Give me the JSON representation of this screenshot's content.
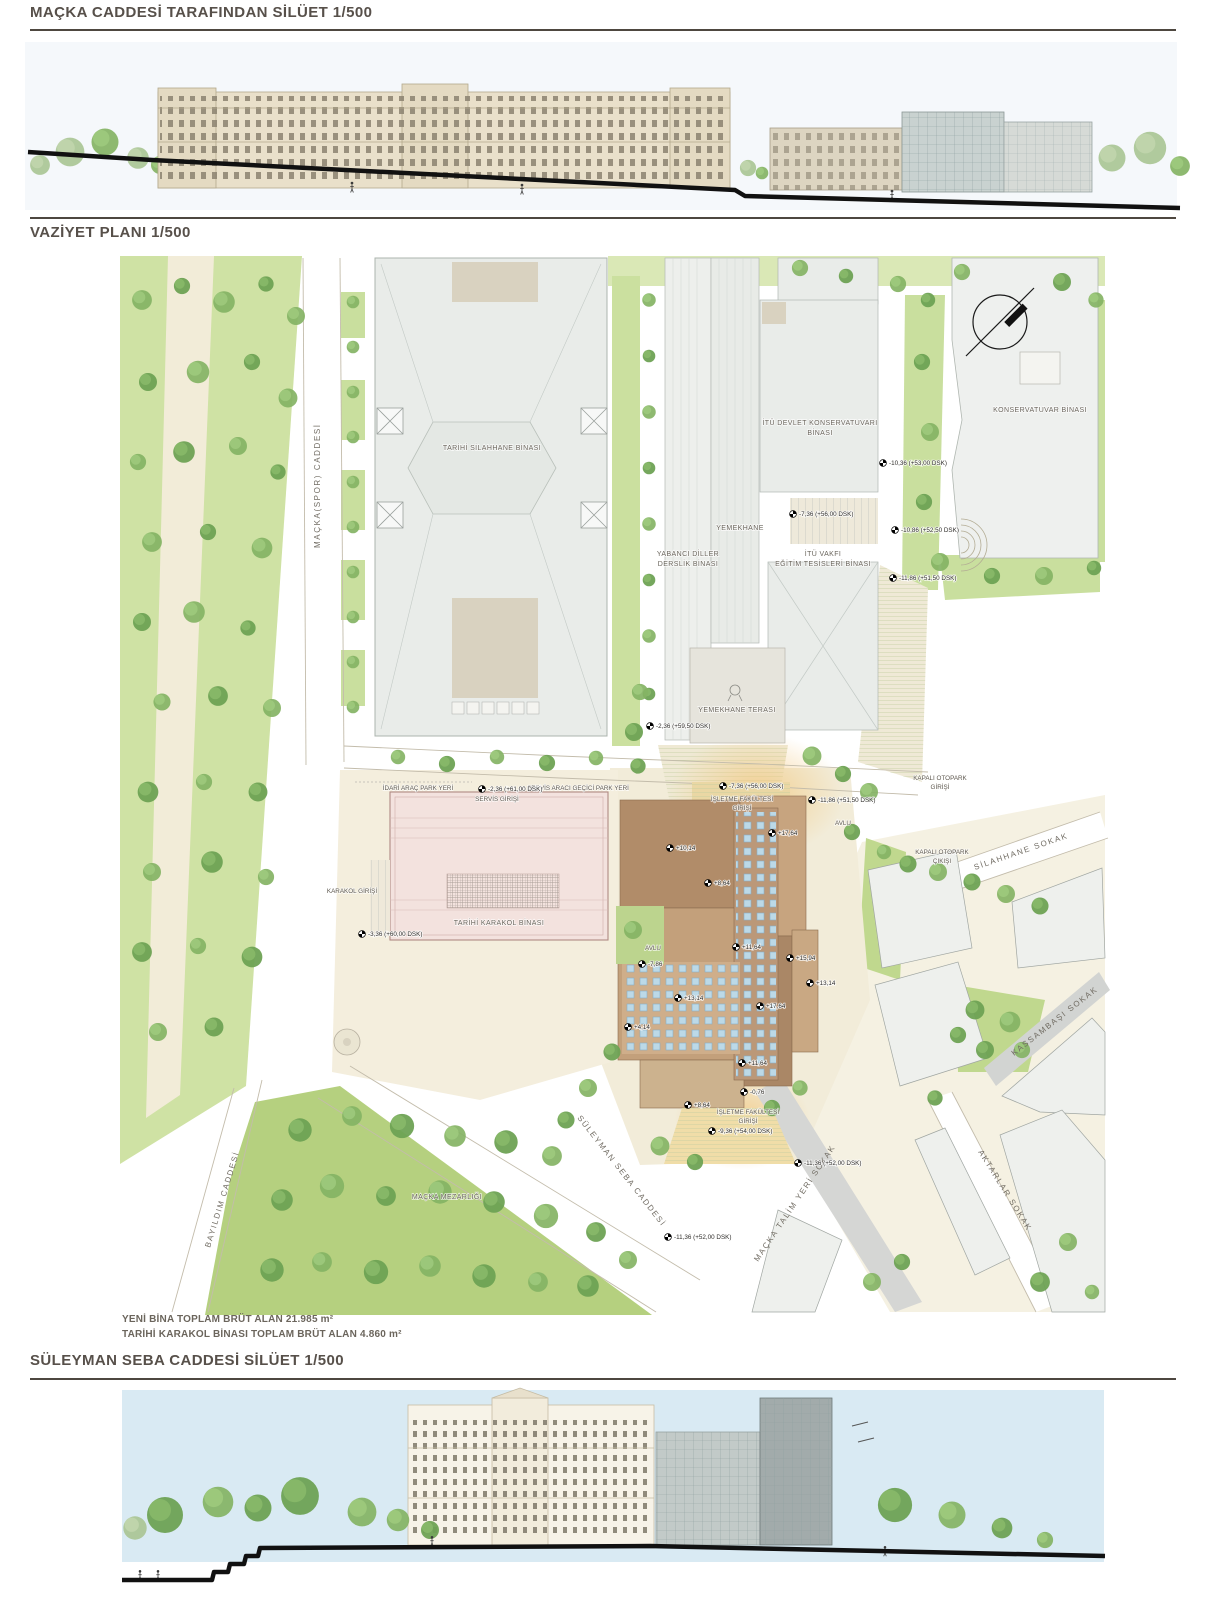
{
  "titles": {
    "top": "MAÇKA CADDESİ TARAFINDAN SİLÜET 1/500",
    "plan": "VAZİYET PLANI 1/500",
    "bottom": "SÜLEYMAN SEBA CADDESİ SİLÜET 1/500"
  },
  "notes": {
    "line1": "YENİ BİNA TOPLAM BRÜT ALAN 21.985  m²",
    "line2": "TARİHİ KARAKOL BİNASI TOPLAM BRÜT ALAN 4.860 m²"
  },
  "plan": {
    "buildings": {
      "silahhane": "TARİHİ SİLAHHANE BİNASI",
      "yabanci1": "YABANCI DİLLER",
      "yabanci2": "DERSLİK BİNASI",
      "yemekhane": "YEMEKHANE",
      "konservatuvari1": "İTÜ DEVLET KONSERVATUVARI",
      "konservatuvari2": "BİNASI",
      "vakfi1": "İTÜ VAKFI",
      "vakfi2": "EĞİTİM TESİSLERİ BİNASI",
      "konservatuvar": "KONSERVATUVAR BİNASI",
      "karakol": "TARİHİ KARAKOL BİNASI",
      "terasi": "YEMEKHANE TERASI",
      "mezarlik": "MAÇKA MEZARLIĞI"
    },
    "streets": {
      "macka_spor": "MAÇKA(SPOR) CADDESİ",
      "silahhane": "SİLAHHANE SOKAK",
      "kassambasi": "KASSAMBAŞI SOKAK",
      "aktarlar": "AKTARLAR SOKAK",
      "suleyman_seba": "SÜLEYMAN SEBA CADDESİ",
      "macka_talim": "MAÇKA TALİM YERİ SOKAK",
      "bayildim": "BAYILDIM CADDESİ"
    },
    "labels": {
      "idari": "İDARİ ARAÇ PARK YERİ",
      "servis_park": "SERVİS ARACI GEÇİCİ PARK YERİ",
      "servis_giris": "SERVİS GİRİŞİ",
      "karakol_giris": "KARAKOL GİRİŞİ",
      "isletme1": "İŞLETME FAKÜLTESİ",
      "isletme2": "GİRİŞİ",
      "otopark_giris1": "KAPALI OTOPARK",
      "otopark_giris2": "GİRİŞİ",
      "otopark_cikis1": "KAPALI OTOPARK",
      "otopark_cikis2": "ÇIKIŞI",
      "avlu": "AVLU",
      "avlu2": "AVLU"
    },
    "markers": [
      "-10,36 (+53,00 DSK)",
      "-7,36 (+56,00 DSK)",
      "-10,86 (+52,50 DSK)",
      "-11,86 (+51,50 DSK)",
      "-2,36 (+59,50 DSK)",
      "-2,36 (+61,00 DSK)",
      "-7,36 (+56,00 DSK)",
      "-11,86 (+51,50 DSK)",
      "-3,36 (+60,00 DSK)",
      "+10,14",
      "+17,64",
      "+8,64",
      "+11,64",
      "+15,94",
      "+13,14",
      "+13,14",
      "+17,64",
      "+4,14",
      "-7,86",
      "+11,64",
      "-0,76",
      "+8,64",
      "-9,36 (+54,00 DSK)",
      "-11,36 (+52,00 DSK)",
      "-11,36 (+52,00 DSK)"
    ]
  },
  "colors": {
    "title_text": "#57504a",
    "grass": "#cfe2a4",
    "tree": "#84b364",
    "new_building_brown": "#b18c69",
    "historic_pink": "#f3e2de",
    "skylight_blue": "#bcd9e7",
    "sky": "#d9eaf3",
    "entrance_glow": "#f3c87e"
  }
}
